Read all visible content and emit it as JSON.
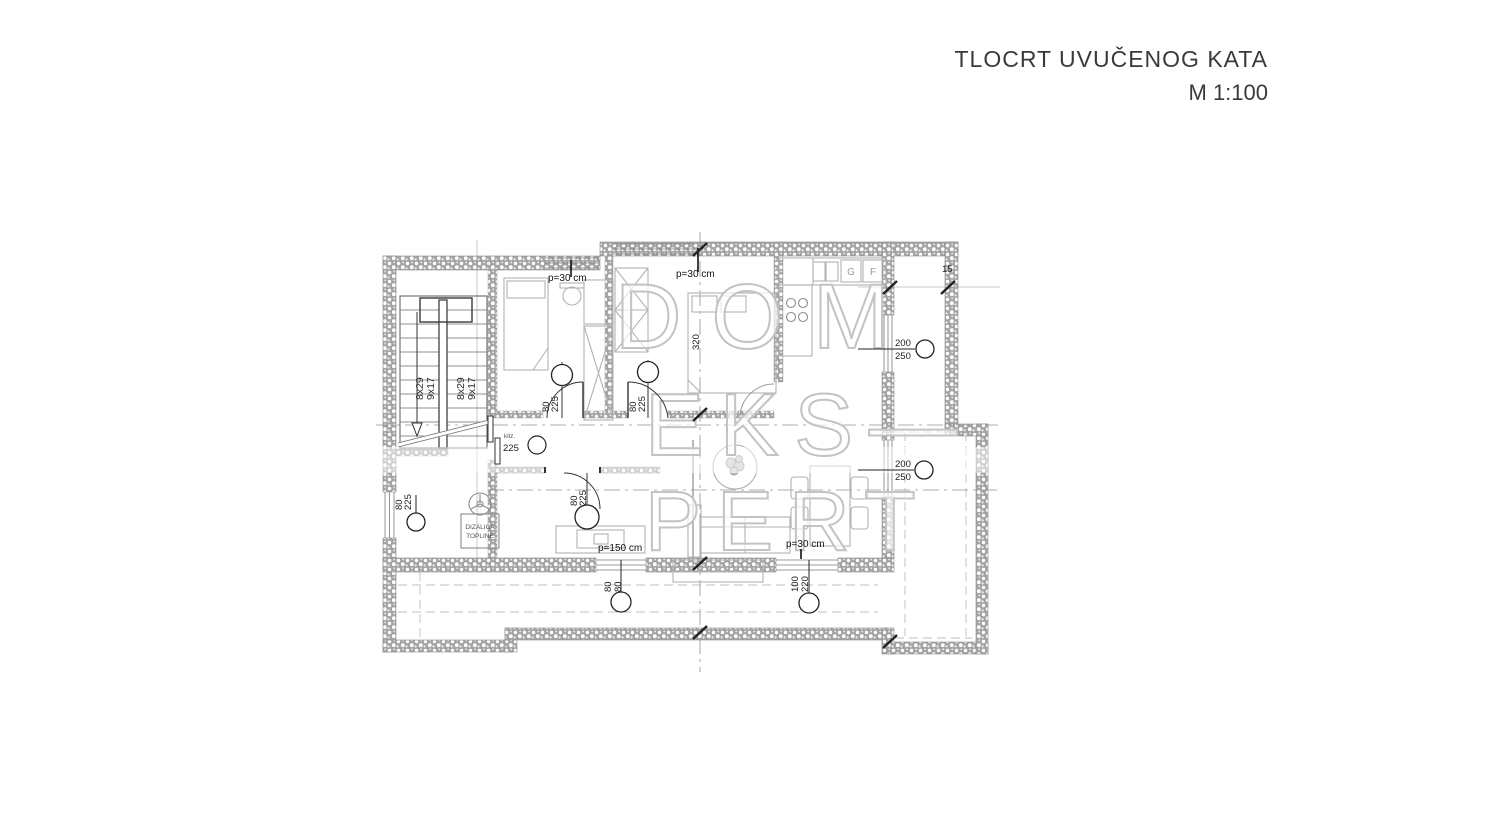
{
  "title": {
    "line1": "TLOCRT UVUČENOG KATA",
    "line2": "M 1:100"
  },
  "watermark": {
    "line1": "DOM",
    "line2": "EKS—",
    "line3": "PERT"
  },
  "plan": {
    "stairs": {
      "flight_left_a": "8x29",
      "flight_left_b": "9x17",
      "flight_right_a": "8x29",
      "flight_right_b": "9x17"
    },
    "labels": {
      "p30_bedroom1": "p=30 cm",
      "p30_bedroom2": "p=30 cm",
      "p30_living": "p=30 cm",
      "p150_terrace": "p=150 cm",
      "dim_15": "15",
      "dim_320": "320",
      "win_right_top_w": "200",
      "win_right_top_h": "250",
      "win_right_bottom_w": "200",
      "win_right_bottom_h": "250",
      "win_left_w": "80",
      "win_left_h": "225",
      "win_terrace_small_w": "80",
      "win_terrace_small_h": "80",
      "door_terrace_w": "100",
      "door_terrace_h": "220",
      "door_bedroom1_w": "80",
      "door_bedroom1_h": "225",
      "door_bedroom2_w": "80",
      "door_bedroom2_h": "225",
      "door_hall_w": "80",
      "door_hall_h": "225",
      "slide_label": "kliz.",
      "slide_size": "225",
      "heatpump_line1": "DIZALICA",
      "heatpump_line2": "TOPLINE",
      "appliance_g": "G",
      "appliance_f": "F"
    }
  }
}
